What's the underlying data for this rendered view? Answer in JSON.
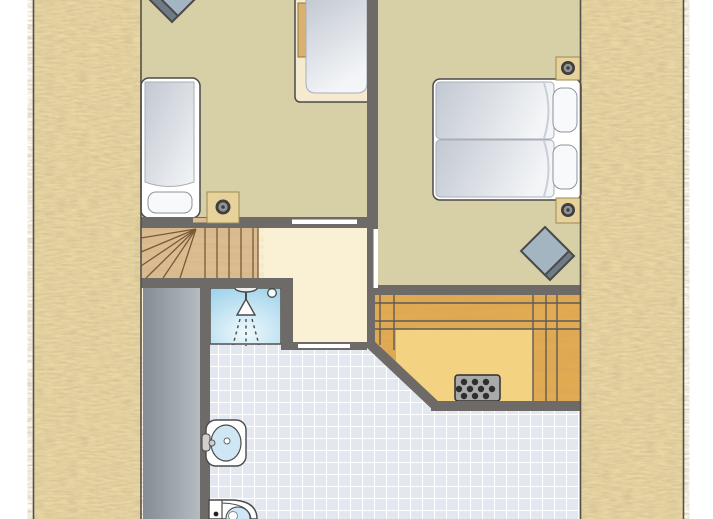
{
  "image_type": "floor-plan",
  "plan": {
    "description": "Attic floor plan of a holiday home between two thatched roof slopes",
    "areas": {
      "roof_left": {
        "name": "thatched-roof-slope-left"
      },
      "roof_right": {
        "name": "thatched-roof-slope-right"
      },
      "bedroom_left": {
        "name": "bedroom-left",
        "furniture": [
          "single-bed-left-wall",
          "single-bed-top-wall",
          "stool",
          "ceiling-spot"
        ]
      },
      "bedroom_right": {
        "name": "bedroom-right",
        "furniture": [
          "double-bed-two-mattresses",
          "stool",
          "ceiling-spot-upper",
          "ceiling-spot-lower"
        ]
      },
      "landing": {
        "name": "landing",
        "features": [
          "winder-staircase",
          "door-to-bedroom-left",
          "door-to-bedroom-right",
          "door-to-bathroom"
        ]
      },
      "shower": {
        "name": "shower-cabin",
        "features": [
          "shower-head-symbol",
          "drain"
        ]
      },
      "bathroom": {
        "name": "bathroom",
        "fixtures": [
          "washbasin-with-tap",
          "toilet"
        ]
      },
      "storage": {
        "name": "storage-under-roof",
        "features": [
          "wooden-floor",
          "floor-grate"
        ]
      },
      "void": {
        "name": "void-gray-area"
      }
    }
  },
  "colors": {
    "page_bg": "#ffffff",
    "boundary": "#55504a",
    "wall": "#6e6a67",
    "door_white": "#ffffff",
    "thatch_base": "#e9d7a4",
    "khaki_floor": "#d7cfa6",
    "cream_floor": "#faf0d4",
    "stair_wood": "#dcbd92",
    "stair_line": "#7a5a38",
    "tech_wood": "#e2ab53",
    "tech_panel": "#f3d382",
    "tech_line": "#5f5b57",
    "void_dark": "#858c92",
    "void_light": "#b4bcc1",
    "shower_edge": "#9fd2ea",
    "shower_center": "#eef9fd",
    "tile_bg": "#e3e8f0",
    "tile_line": "#ffffff",
    "frame_white": "#ffffff",
    "outline": "#4a4a4a",
    "mattress_dark": "#c2c8d2",
    "mattress_light": "#f3f5f7",
    "pillow": "#f8f9fb",
    "bedB_frame": "#f3ead0",
    "wood_strip": "#d9b271",
    "spot_block": "#e6d29a",
    "spot_ring": "#3f3f3f",
    "spot_mid": "#949494",
    "stool_fill": "#a4b5c2",
    "stool_shadow": "#6e7a84",
    "grate_fill": "#a9a9a9",
    "grate_dot": "#2e2e2e",
    "fixture_blue": "#cfe7f5"
  }
}
